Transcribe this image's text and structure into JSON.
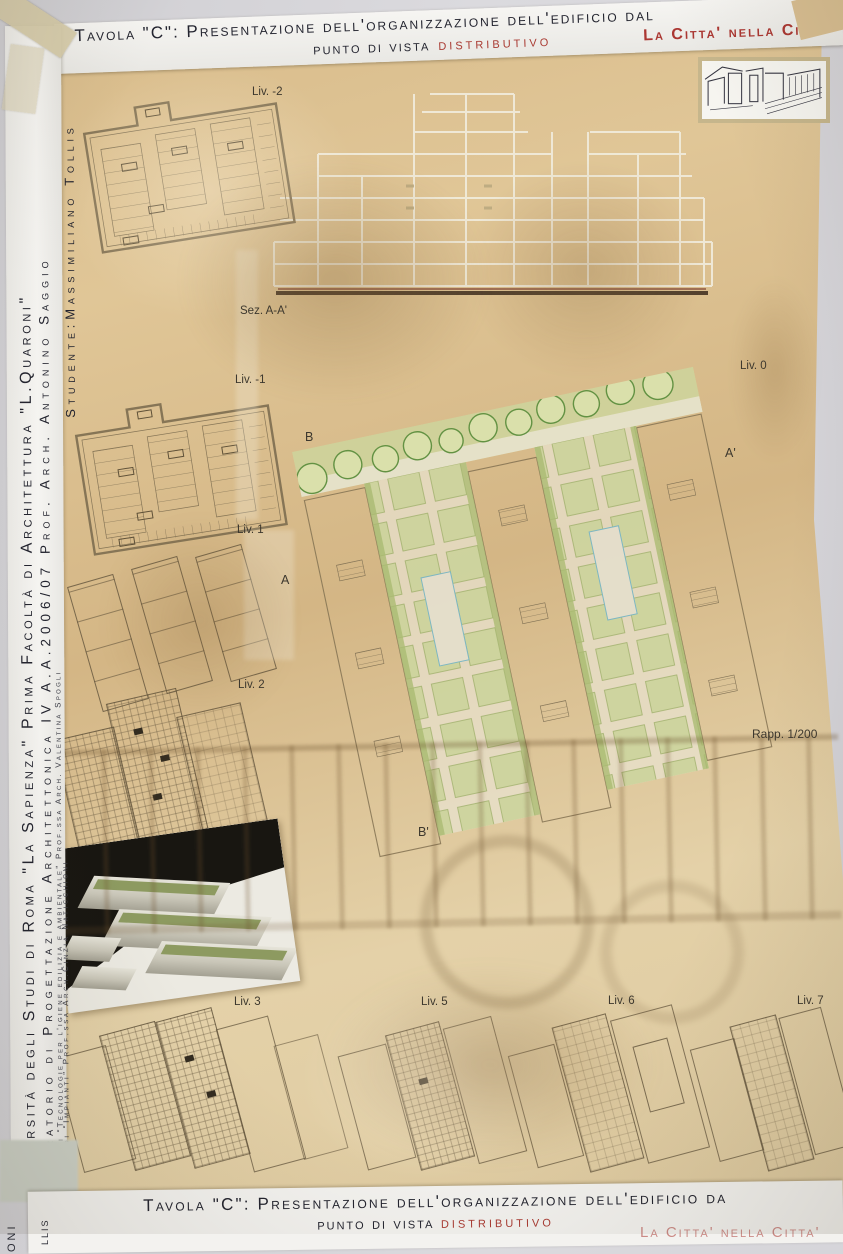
{
  "board": {
    "accent_red": "#a93a32",
    "header": {
      "line1": "Tavola \"C\": Presentazione dell'organizzazione dell'edificio dal",
      "line2_prefix": "punto di vista",
      "line2_highlight": "distributivo",
      "motto": "La Citta' nella Citta'"
    },
    "title_block": {
      "university": "Università degli Studi di Roma \"La Sapienza\" Prima Facoltà di Architettura \"L.Quaroni\"",
      "course": "Laboratorio di Progettazione Architettonica IV A.A.2006/07 Prof. Arch. Antonino Saggio",
      "module1": "Modulo di \"Tecnologie per l'igiene edilizia e ambientale\" Prof.ssa Arch. Valentina Spogli",
      "module2": "Modulo di \"Impianti\" Prof.ssa Arch.Cinzia Naticchioni",
      "student": "Studente:Massimiliano Tollis"
    },
    "labels": {
      "liv_minus2": "Liv. -2",
      "section_aa": "Sez. A-A'",
      "liv_minus1": "Liv. -1",
      "liv_0": "Liv. 0",
      "liv_1": "Liv. 1",
      "liv_2": "Liv. 2",
      "liv_3": "Liv. 3",
      "liv_5": "Liv. 5",
      "liv_6": "Liv. 6",
      "liv_7": "Liv. 7"
    },
    "section_markers": {
      "b": "B",
      "a": "A",
      "a_prime": "A'",
      "b_prime": "B'"
    },
    "scale_note": "Rapp. 1/200"
  },
  "next_board": {
    "line1": "Tavola \"C\": Presentazione dell'organizzazione dell'edificio da",
    "line2_prefix": "punto di vista",
    "line2_highlight": "distributivo",
    "motto_partial": "La Citta' nella Citta'",
    "side_fragment1": "oni",
    "side_fragment2": "llis"
  }
}
